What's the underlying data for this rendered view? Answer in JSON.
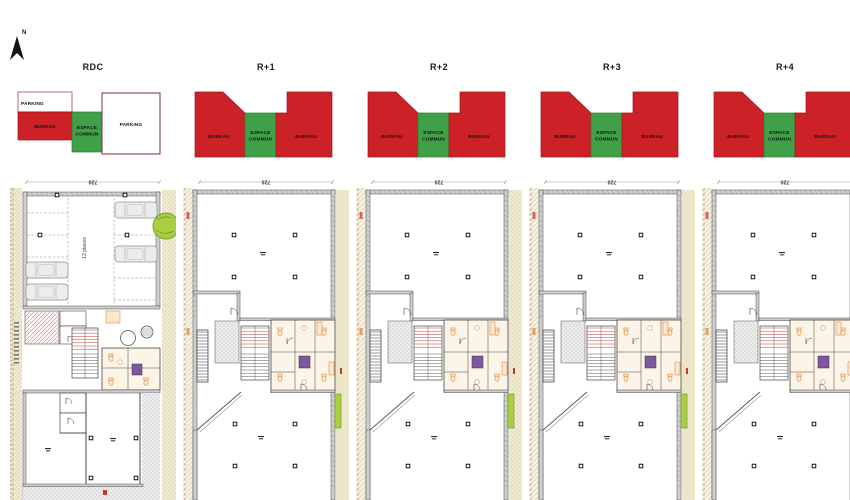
{
  "north_arrow": {
    "label": "N"
  },
  "colors": {
    "bureau_red": "#cb2127",
    "bureau_red_edge": "#a0181d",
    "espace_green": "#3fa047",
    "espace_green_edge": "#2d7d34",
    "parking_border_light": "#d0898f",
    "parking_border_dark": "#7d2b33",
    "wall_gray": "#cfcfcf",
    "line_dark": "#4a4a4a",
    "hatch_yellow": "#f0ead0",
    "hatch_yellow_dot": "#c9bd8d",
    "fixture_orange": "#dd8e3f",
    "fixture_fill": "#fbe7cf",
    "core_tint": "#fdf4e8",
    "accent_red": "#c23b2e",
    "elevator_purple": "#7e57a0",
    "tree_green": "#a9ce41",
    "tree_edge": "#6f9a2a",
    "stipple_gray": "#ececec",
    "stipple_dot": "#a8a8a8"
  },
  "floors": [
    {
      "id": "rdc",
      "title": "RDC",
      "plan": "parking",
      "zones": [
        {
          "label": "PARKING"
        },
        {
          "label": "BUREAU"
        },
        {
          "label": "ESPACE COMMUN"
        },
        {
          "label": "PARKING"
        }
      ]
    },
    {
      "id": "r1",
      "title": "R+1",
      "plan": "office",
      "zones": [
        {
          "label": "BUREAU"
        },
        {
          "label": "ESPACE COMMUN"
        },
        {
          "label": "BUREAU"
        }
      ]
    },
    {
      "id": "r2",
      "title": "R+2",
      "plan": "office",
      "zones": [
        {
          "label": "BUREAU"
        },
        {
          "label": "ESPACE COMMUN"
        },
        {
          "label": "BUREAU"
        }
      ]
    },
    {
      "id": "r3",
      "title": "R+3",
      "plan": "office",
      "zones": [
        {
          "label": "BUREAU"
        },
        {
          "label": "ESPACE COMMUN"
        },
        {
          "label": "BUREAU"
        }
      ]
    },
    {
      "id": "r4",
      "title": "R+4",
      "plan": "office",
      "zones": [
        {
          "label": "BUREAU"
        },
        {
          "label": "ESPACE COMMUN"
        },
        {
          "label": "BUREAU"
        }
      ]
    }
  ],
  "plan_annotations": {
    "dimension": "720",
    "parking_capacity": "12 places"
  }
}
